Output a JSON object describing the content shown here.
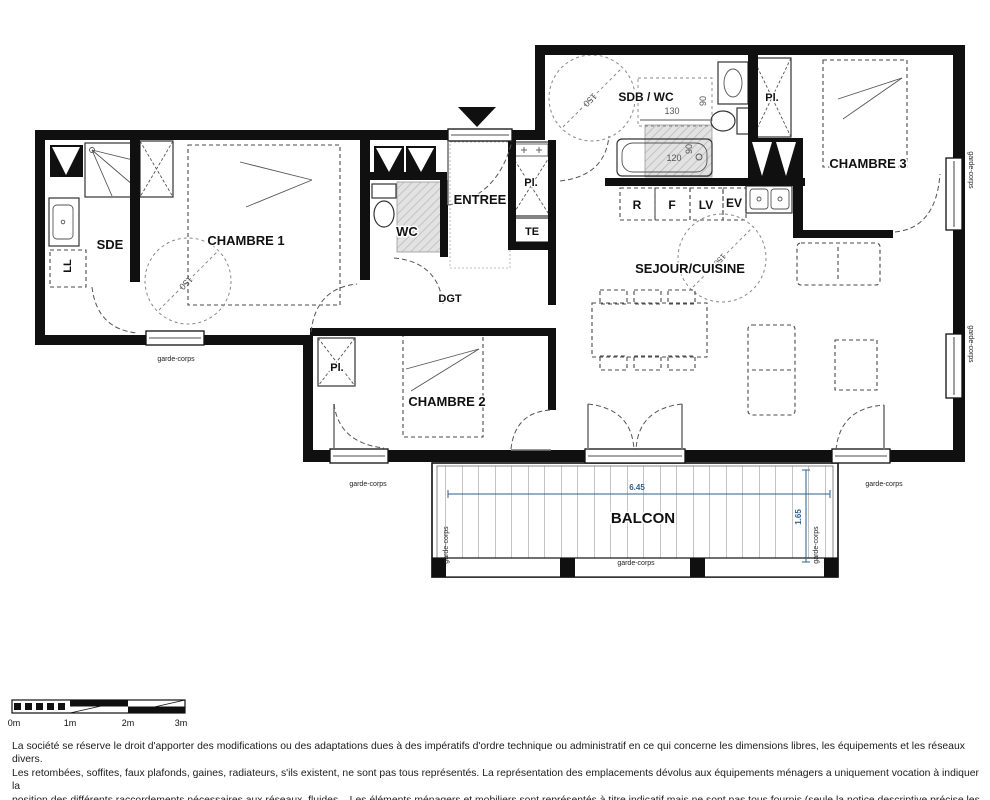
{
  "plan": {
    "rooms": {
      "sde": "SDE",
      "chambre1": "CHAMBRE 1",
      "chambre2": "CHAMBRE 2",
      "chambre3": "CHAMBRE 3",
      "wc": "WC",
      "entree": "ENTREE",
      "dgt": "DGT",
      "sdb_wc": "SDB / WC",
      "sejour": "SEJOUR/CUISINE",
      "balcon": "BALCON"
    },
    "closets": {
      "pl": "Pl.",
      "te": "TE",
      "ll": "LL"
    },
    "kitchen": {
      "fridge": "R",
      "oven": "F",
      "dishwasher": "LV",
      "sink": "EV"
    },
    "dims": {
      "turning_circle": "150",
      "sdb_width": "130",
      "sdb_depth": "90",
      "bath_length": "120",
      "bath_width": "90"
    },
    "balcony": {
      "width": "6.45",
      "depth": "1.65"
    },
    "railing": "garde-corps",
    "colors": {
      "dimension_blue": "#2e5f8f",
      "hatch_fill": "#e2e2e2"
    }
  },
  "scale_bar": {
    "labels": [
      "0m",
      "1m",
      "2m",
      "3m"
    ]
  },
  "disclaimer": {
    "lines": [
      "La société se réserve le droit d'apporter des modifications ou des adaptations dues à des impératifs d'ordre technique ou administratif en ce qui concerne les dimensions libres, les équipements et les réseaux divers.",
      "Les retombées, soffites, faux plafonds, gaines, radiateurs, s'ils existent, ne sont pas tous représentés. La représentation des emplacements dévolus aux équipements ménagers a uniquement vocation à indiquer la",
      "position des différents raccordements nécessaires aux réseaux, fluides... Les éléments ménagers et mobiliers sont représentés à titre indicatif mais ne sont pas tous fournis (seule la notice descriptive précise les",
      "équipements fournis). Les surfaces y compris celles des loggias sont approximatives et susceptibles d'être modifiées."
    ]
  }
}
